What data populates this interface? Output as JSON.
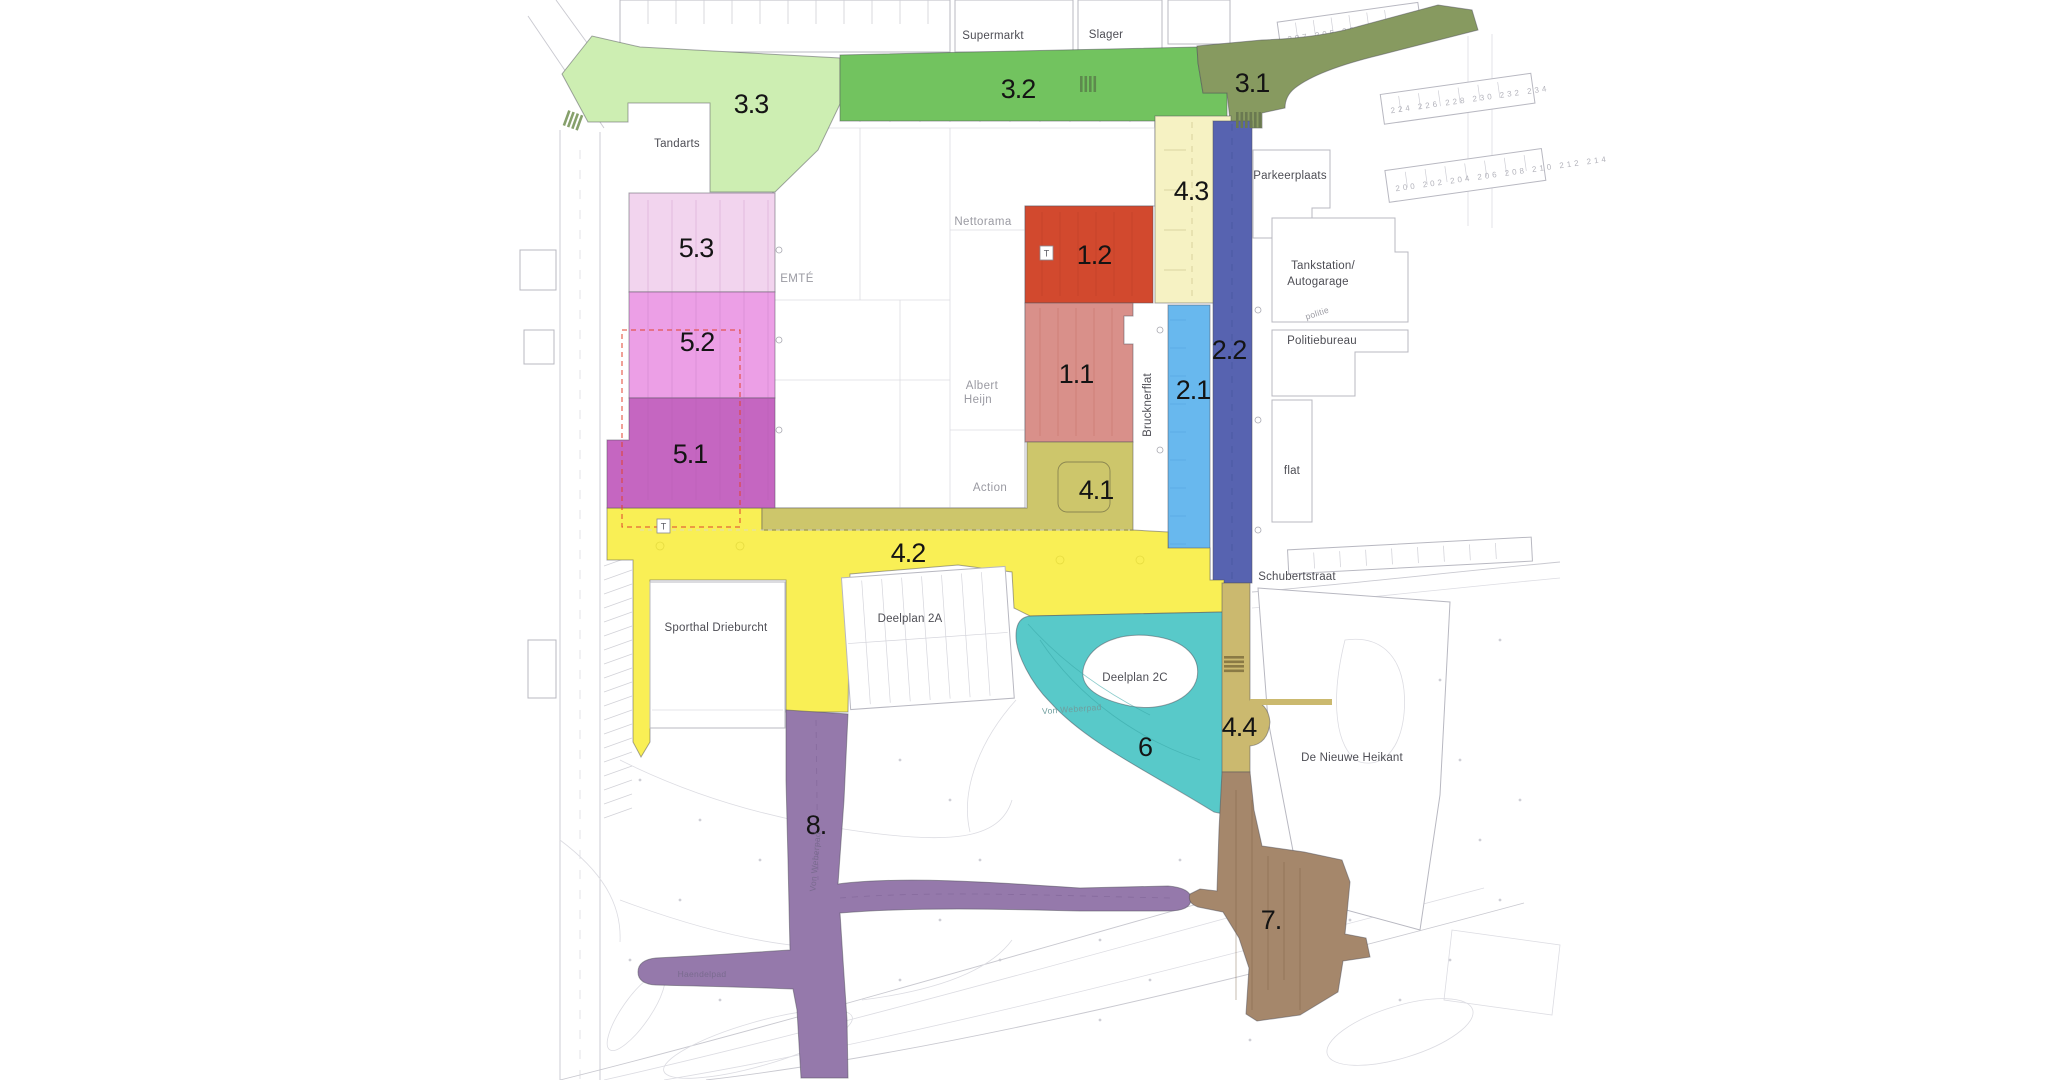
{
  "title": "Stedenbouwkundig deelplan Wagnerplein",
  "zones": [
    {
      "label": "1.1",
      "color": "#d9908a"
    },
    {
      "label": "1.2",
      "color": "#d2492e"
    },
    {
      "label": "2.1",
      "color": "#68b8ee"
    },
    {
      "label": "2.2",
      "color": "#5763b0"
    },
    {
      "label": "3.1",
      "color": "#879a60"
    },
    {
      "label": "3.2",
      "color": "#72c35f"
    },
    {
      "label": "3.3",
      "color": "#cdeeb2"
    },
    {
      "label": "4.1",
      "color": "#cdc66b"
    },
    {
      "label": "4.2",
      "color": "#f9ef55"
    },
    {
      "label": "4.3",
      "color": "#f6f2c3"
    },
    {
      "label": "4.4",
      "color": "#cbb96f"
    },
    {
      "label": "5.1",
      "color": "#c566c1"
    },
    {
      "label": "5.2",
      "color": "#ec9fe6"
    },
    {
      "label": "5.3",
      "color": "#f2d4ee"
    },
    {
      "label": "6",
      "color": "#58c9c9"
    },
    {
      "label": "7.",
      "color": "#a5876b"
    },
    {
      "label": "8.",
      "color": "#9579ab"
    }
  ],
  "places": {
    "supermarkt": "Supermarkt",
    "slager": "Slager",
    "tandarts": "Tandarts",
    "parkeerplaats": "Parkeerplaats",
    "tankstation_line1": "Tankstation/",
    "tankstation_line2": "Autogarage",
    "politiebureau": "Politiebureau",
    "politie_small": "politie",
    "flat": "flat",
    "nettorama": "Nettorama",
    "emte": "EMTÉ",
    "albert": "Albert",
    "heijn": "Heijn",
    "action": "Action",
    "brucknerflat": "Brucknerflat",
    "sporthal": "Sporthal Drieburcht",
    "deelplan2a": "Deelplan 2A",
    "deelplan2c": "Deelplan 2C",
    "nieuwe_heikant": "De Nieuwe Heikant",
    "schubertstraat": "Schubertstraat",
    "von_weberpad": "Von Weberpad",
    "von_weberpad_vertical": "Von Weberpad",
    "haendelpad": "Haendelpad"
  },
  "markers": {
    "t1": "T",
    "t2": "T"
  },
  "house_numbers": {
    "row_top": "207  205  203  201  199  197",
    "row_mid": "224  226  228  230  232  234",
    "row_low": "200  202  204  206  208  210  212  214"
  }
}
